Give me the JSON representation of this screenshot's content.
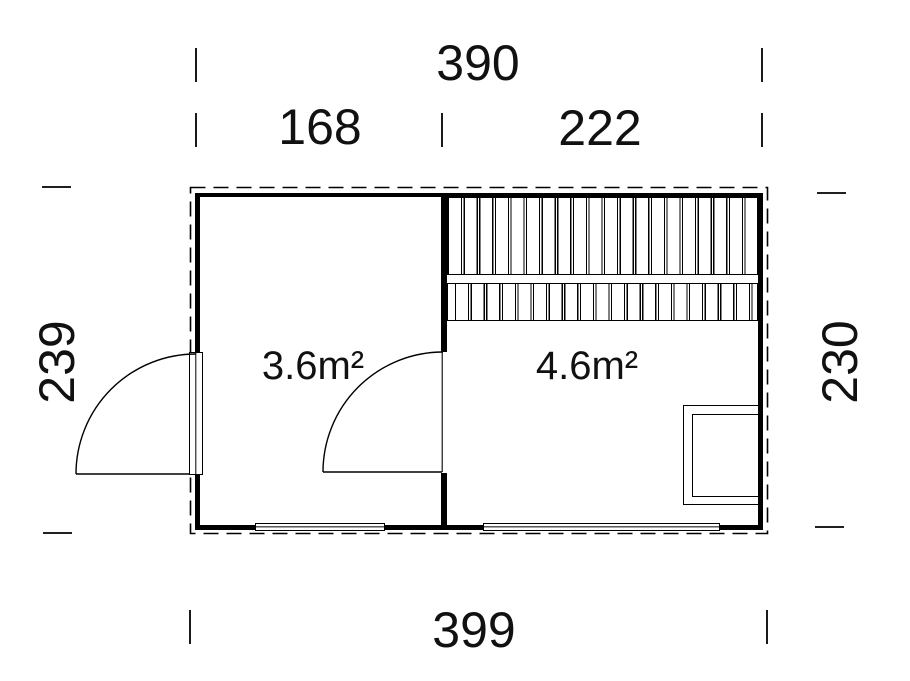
{
  "drawing": {
    "type": "floor-plan",
    "colors": {
      "background": "#ffffff",
      "lines": "#000000",
      "text": "#111111"
    },
    "dimensions": {
      "top_total": "390",
      "top_left_segment": "168",
      "top_right_segment": "222",
      "side_left": "239",
      "side_right": "230",
      "bottom_total": "399"
    },
    "rooms": [
      {
        "id": "left-room",
        "area_label": "3.6m²"
      },
      {
        "id": "right-room",
        "area_label": "4.6m²"
      }
    ]
  }
}
